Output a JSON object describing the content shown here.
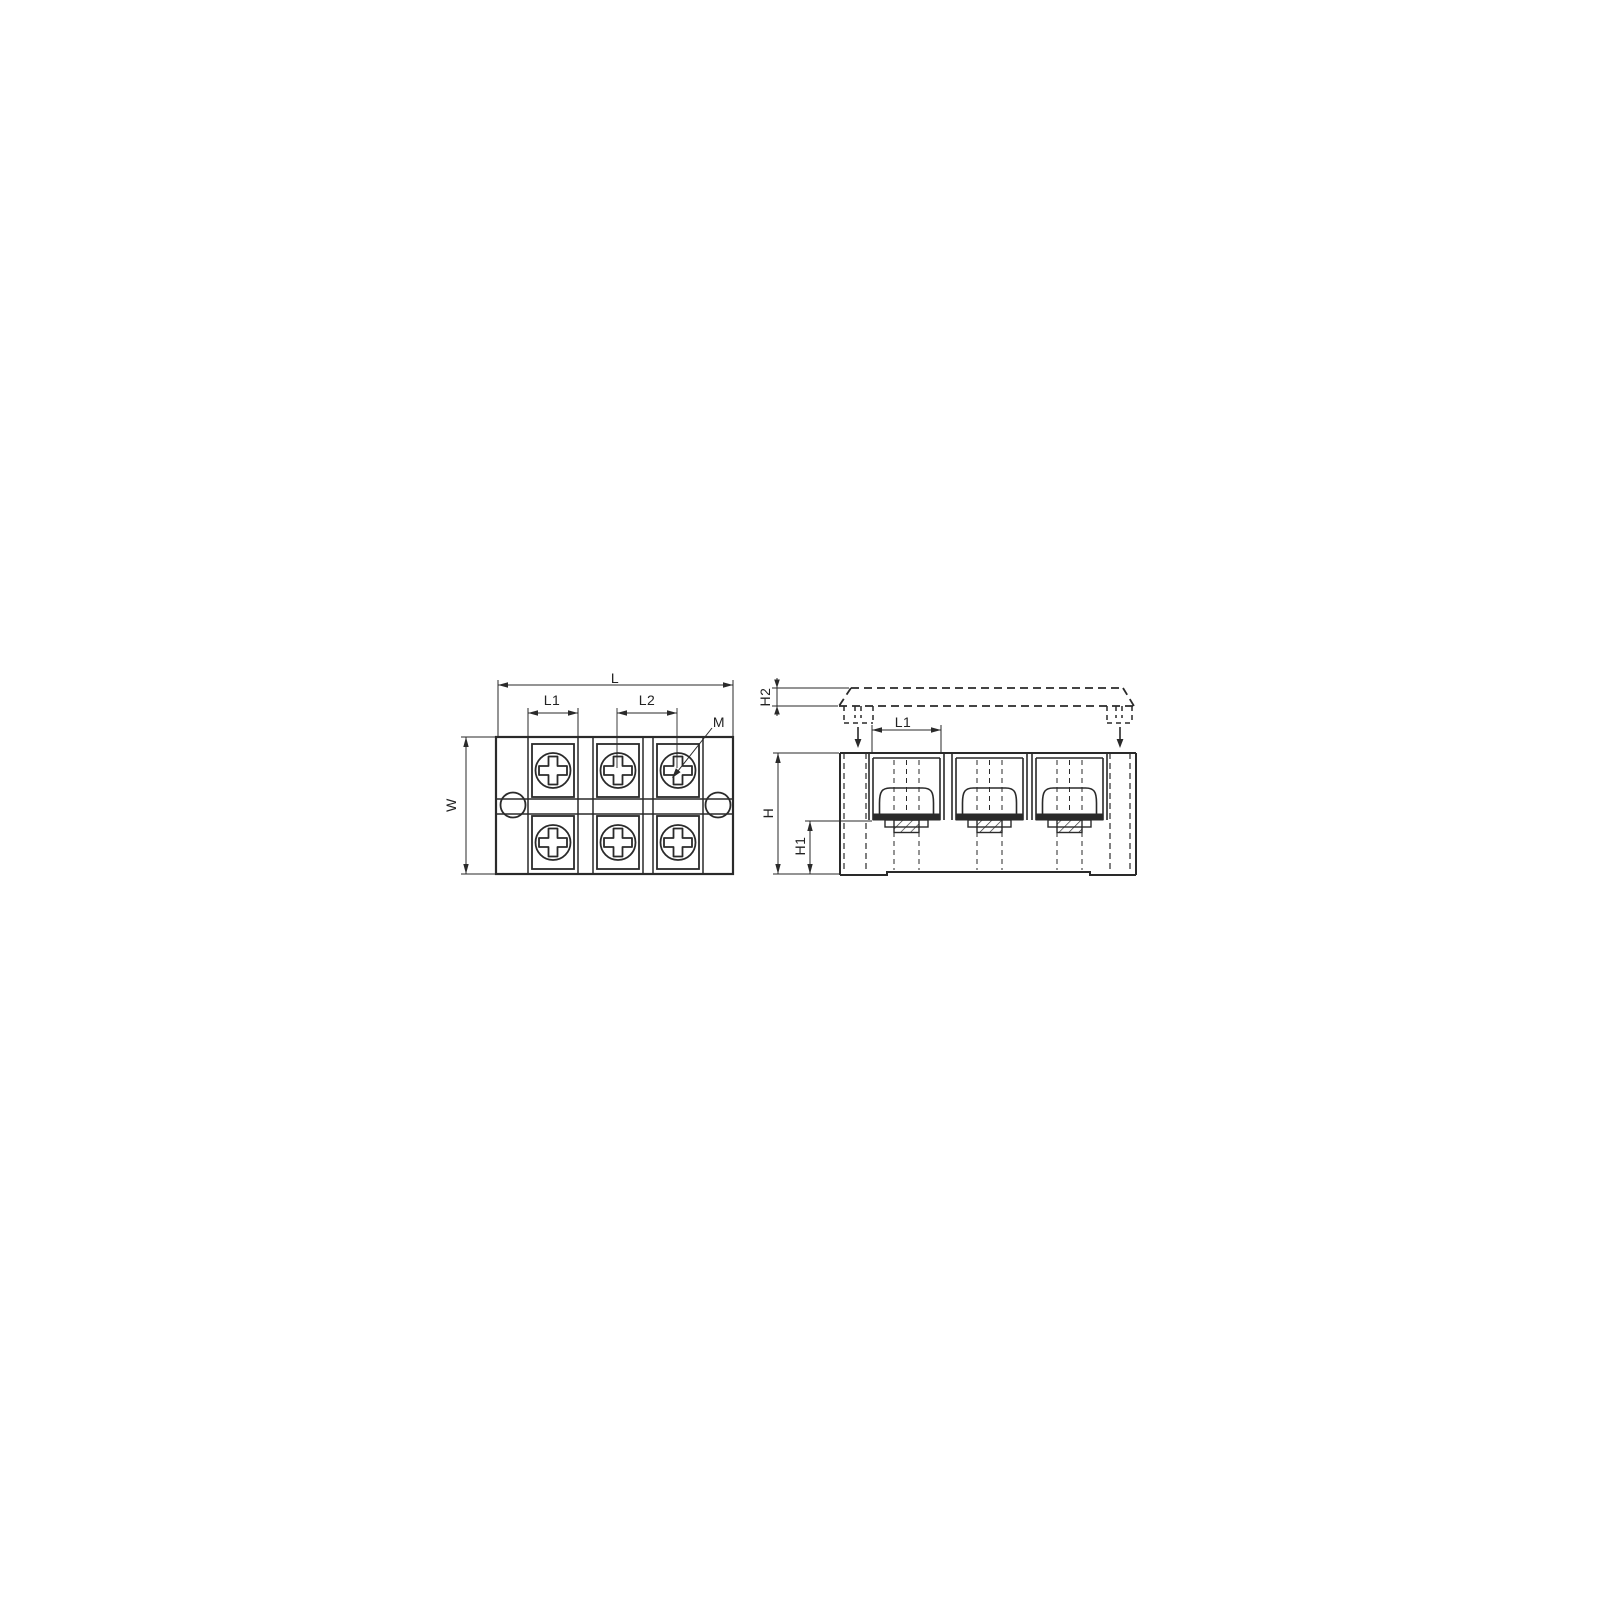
{
  "colors": {
    "background": "#ffffff",
    "line": "#2a2a2a",
    "washer_fill": "#2a2a2a",
    "label_text": "#222222"
  },
  "labels": {
    "top_view": {
      "length": "L",
      "pole_pitch_1": "L1",
      "pole_pitch_2": "L2",
      "screw_size": "M",
      "width": "W"
    },
    "side_view": {
      "cover_height": "H2",
      "pole_pitch": "L1",
      "height": "H",
      "height_1": "H1"
    }
  }
}
